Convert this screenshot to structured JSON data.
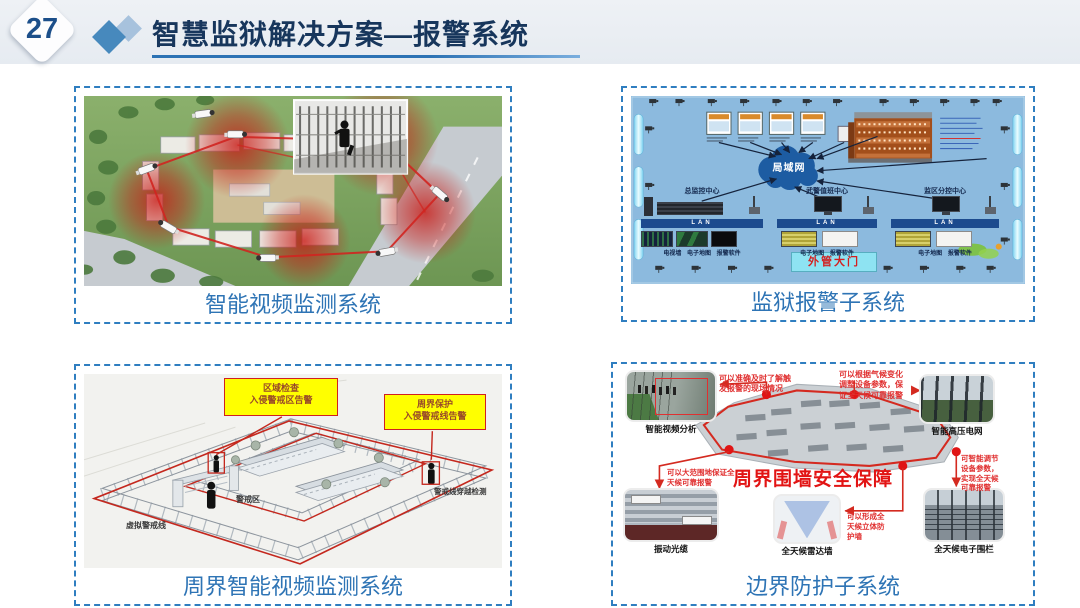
{
  "slide": {
    "page_number": "27",
    "title": "智慧监狱解决方案—报警系统"
  },
  "colors": {
    "accent_blue": "#2e75b6",
    "title_navy": "#17365c",
    "caption_blue": "#2e74b5",
    "alert_red": "#e21414",
    "callout_yellow": "#ffff00"
  },
  "panel_video_monitoring": {
    "caption": "智能视频监测系统"
  },
  "panel_prison_alarm": {
    "caption": "监狱报警子系统",
    "cloud_label": "局域网",
    "gate_label": "外管大门",
    "stations": [
      {
        "name": "总监控中心",
        "lan": "LAN",
        "devices": "电视墙 电子地图 报警软件"
      },
      {
        "name": "武警值班中心",
        "lan": "LAN",
        "devices": "电子地图 报警软件"
      },
      {
        "name": "监区分控中心",
        "lan": "LAN",
        "devices": "电子地图 报警软件"
      }
    ]
  },
  "panel_perimeter_video": {
    "caption": "周界智能视频监测系统",
    "callout_area": "区域检查\n入侵警戒区告警",
    "callout_perimeter": "周界保护\n入侵警戒线告警",
    "label_virtual_line": "虚拟警戒线",
    "label_zone": "警戒区",
    "label_crossing": "警戒线穿越检测"
  },
  "panel_boundary_protection": {
    "caption": "边界防护子系统",
    "headline": "周界围墙安全保障",
    "photos": {
      "video_analysis": "智能视频分析",
      "hv_grid": "智能高压电网",
      "fiber": "振动光缆",
      "radar_wall": "全天候雷达墙",
      "efence": "全天候电子围栏"
    },
    "notes": {
      "scene": "可以准确及时了解触\n发报警的现场情况",
      "climate": "可以根据气候变化\n调整设备参数，保\n证全天候可靠报警",
      "range": "可以大范围地保证全\n天候可靠报警",
      "wall": "可以形成全\n天候立体防\n护墙",
      "adjust": "可智能调节\n设备参数，\n实现全天候\n可靠报警"
    }
  }
}
